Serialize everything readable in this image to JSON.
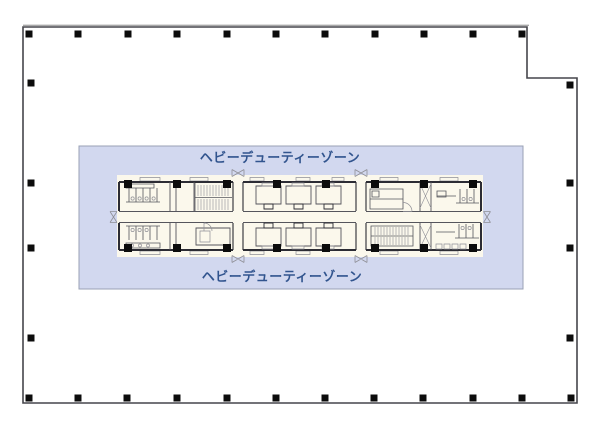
{
  "zone": {
    "label_top": "ヘビーデューティーゾーン",
    "label_bottom": "ヘビーデューティーゾーン",
    "fill": "#d2d8ef",
    "border": "#99a1b5",
    "label_color": "#31548e",
    "rect": {
      "x": 79,
      "y": 146,
      "w": 444,
      "h": 143
    }
  },
  "outline": {
    "color": "#45454b",
    "shadow_color": "#a8a8a8",
    "points": "23,27 527,27 527,78 577,78 577,403 23,403"
  },
  "columns": {
    "color": "#0c0c0c",
    "perimeter": {
      "size": 7,
      "top": {
        "y": 34,
        "xs": [
          29,
          78,
          128,
          177,
          227,
          276,
          325,
          375,
          424,
          473,
          522
        ]
      },
      "bottom": {
        "y": 398,
        "xs": [
          29,
          78,
          127,
          177,
          227,
          276,
          325,
          374,
          423,
          473,
          522,
          571
        ]
      },
      "left": {
        "x": 31,
        "ys": [
          83,
          183,
          248,
          338
        ]
      },
      "right": {
        "x": 570,
        "ys": [
          85,
          183,
          248,
          338
        ]
      }
    },
    "core": {
      "size": 8,
      "xs": [
        128,
        177,
        227,
        277,
        326,
        375,
        424,
        473
      ],
      "ys": [
        184,
        248
      ]
    }
  },
  "plan": {
    "paper": "#fbf8ec",
    "wall": "#2c2c34",
    "line": "#55555c",
    "light": "#8f8f96"
  }
}
